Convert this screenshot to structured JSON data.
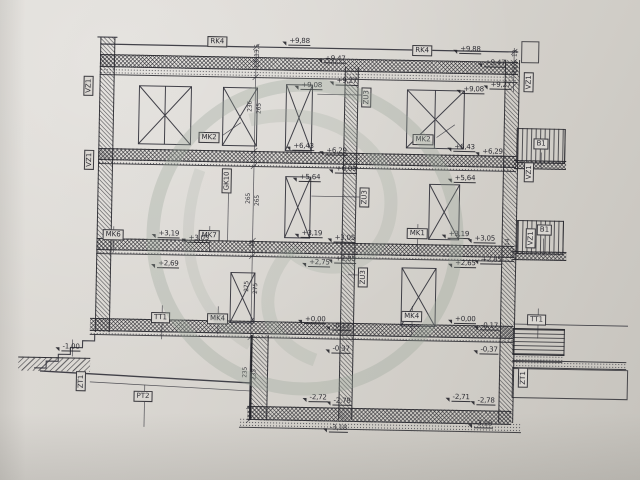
{
  "drawing": {
    "type": "architectural-building-section",
    "colors": {
      "ink": "#30303a",
      "paper": "#d8d5d0",
      "paper_dark": "#c6c3bd",
      "watermark": "#93a896"
    },
    "labels": [
      {
        "text": "RK4",
        "x": 207,
        "y": 34,
        "vertical": false
      },
      {
        "text": "RK4",
        "x": 412,
        "y": 39,
        "vertical": false
      },
      {
        "text": "VZ1",
        "x": 84,
        "y": 76,
        "vertical": true
      },
      {
        "text": "VZ1",
        "x": 86,
        "y": 150,
        "vertical": true
      },
      {
        "text": "VZ1",
        "x": 524,
        "y": 64,
        "vertical": true
      },
      {
        "text": "VZ1",
        "x": 526,
        "y": 154,
        "vertical": true
      },
      {
        "text": "VZ1",
        "x": 529,
        "y": 220,
        "vertical": true
      },
      {
        "text": "MK2",
        "x": 200,
        "y": 130,
        "vertical": false
      },
      {
        "text": "MK2",
        "x": 414,
        "y": 128,
        "vertical": false
      },
      {
        "text": "ZU3",
        "x": 362,
        "y": 82,
        "vertical": true
      },
      {
        "text": "ZU3",
        "x": 362,
        "y": 182,
        "vertical": true
      },
      {
        "text": "ZU3",
        "x": 362,
        "y": 262,
        "vertical": true
      },
      {
        "text": "GK10",
        "x": 224,
        "y": 166,
        "vertical": true
      },
      {
        "text": "MK6",
        "x": 106,
        "y": 229,
        "vertical": false
      },
      {
        "text": "MK7",
        "x": 202,
        "y": 228,
        "vertical": false
      },
      {
        "text": "MK1",
        "x": 410,
        "y": 222,
        "vertical": false
      },
      {
        "text": "MK4",
        "x": 212,
        "y": 311,
        "vertical": false
      },
      {
        "text": "MK4",
        "x": 406,
        "y": 305,
        "vertical": false
      },
      {
        "text": "TT1",
        "x": 156,
        "y": 311,
        "vertical": false
      },
      {
        "text": "TT1",
        "x": 532,
        "y": 306,
        "vertical": false
      },
      {
        "text": "ZT1",
        "x": 82,
        "y": 372,
        "vertical": true
      },
      {
        "text": "ZT1",
        "x": 524,
        "y": 360,
        "vertical": true
      },
      {
        "text": "PT2",
        "x": 140,
        "y": 390,
        "vertical": false
      },
      {
        "text": "B1",
        "x": 535,
        "y": 130,
        "vertical": false
      },
      {
        "text": "B1",
        "x": 540,
        "y": 216,
        "vertical": false
      }
    ],
    "elevations": [
      {
        "text": "+9,88",
        "x": 281,
        "y": 33
      },
      {
        "text": "+9,47",
        "x": 317,
        "y": 50
      },
      {
        "text": "+9,88",
        "x": 452,
        "y": 38
      },
      {
        "text": "+9,47",
        "x": 477,
        "y": 51
      },
      {
        "text": "+9,08",
        "x": 294,
        "y": 77
      },
      {
        "text": "+9,27",
        "x": 329,
        "y": 72
      },
      {
        "text": "+9,08",
        "x": 456,
        "y": 78
      },
      {
        "text": "+9,27",
        "x": 483,
        "y": 73
      },
      {
        "text": "+6,43",
        "x": 287,
        "y": 138
      },
      {
        "text": "+6,29",
        "x": 320,
        "y": 142
      },
      {
        "text": "+6,43",
        "x": 448,
        "y": 136
      },
      {
        "text": "+6,29",
        "x": 476,
        "y": 140
      },
      {
        "text": "+6,09",
        "x": 330,
        "y": 160
      },
      {
        "text": "+5,64",
        "x": 294,
        "y": 169
      },
      {
        "text": "+5,64",
        "x": 449,
        "y": 167
      },
      {
        "text": "+3,19",
        "x": 154,
        "y": 228
      },
      {
        "text": "+3,05",
        "x": 184,
        "y": 232
      },
      {
        "text": "+3,19",
        "x": 297,
        "y": 225
      },
      {
        "text": "+3,05",
        "x": 330,
        "y": 229
      },
      {
        "text": "+3,19",
        "x": 444,
        "y": 223
      },
      {
        "text": "+3,05",
        "x": 470,
        "y": 227
      },
      {
        "text": "+2,69",
        "x": 154,
        "y": 258
      },
      {
        "text": "+2,75",
        "x": 305,
        "y": 254
      },
      {
        "text": "+2,85",
        "x": 331,
        "y": 250
      },
      {
        "text": "+2,65",
        "x": 451,
        "y": 252
      },
      {
        "text": "+2,85",
        "x": 477,
        "y": 248
      },
      {
        "text": "+0,00",
        "x": 302,
        "y": 311
      },
      {
        "text": "-0,17",
        "x": 330,
        "y": 317
      },
      {
        "text": "+0,00",
        "x": 452,
        "y": 308
      },
      {
        "text": "-0,17",
        "x": 478,
        "y": 314
      },
      {
        "text": "-0,37",
        "x": 330,
        "y": 340
      },
      {
        "text": "-0,37",
        "x": 478,
        "y": 338
      },
      {
        "text": "-1,00",
        "x": 60,
        "y": 343
      },
      {
        "text": "-2,72",
        "x": 308,
        "y": 389
      },
      {
        "text": "-2,78",
        "x": 332,
        "y": 392
      },
      {
        "text": "-2,71",
        "x": 451,
        "y": 386
      },
      {
        "text": "-2,78",
        "x": 476,
        "y": 389
      },
      {
        "text": "-3,18",
        "x": 329,
        "y": 419
      },
      {
        "text": "-3,18",
        "x": 474,
        "y": 412
      }
    ],
    "dimensions": [
      {
        "text": "13,5",
        "x": 248,
        "y": 44
      },
      {
        "text": "13",
        "x": 248,
        "y": 58
      },
      {
        "text": "236",
        "x": 242,
        "y": 100
      },
      {
        "text": "265",
        "x": 251,
        "y": 102
      },
      {
        "text": "265",
        "x": 242,
        "y": 192
      },
      {
        "text": "265",
        "x": 251,
        "y": 194
      },
      {
        "text": "14",
        "x": 247,
        "y": 237
      },
      {
        "text": "275",
        "x": 242,
        "y": 280
      },
      {
        "text": "275",
        "x": 251,
        "y": 282
      },
      {
        "text": "235",
        "x": 242,
        "y": 366
      },
      {
        "text": "235",
        "x": 251,
        "y": 368
      },
      {
        "text": "13",
        "x": 506,
        "y": 42
      },
      {
        "text": "13,5",
        "x": 506,
        "y": 56
      },
      {
        "text": "14",
        "x": 502,
        "y": 231
      }
    ]
  }
}
